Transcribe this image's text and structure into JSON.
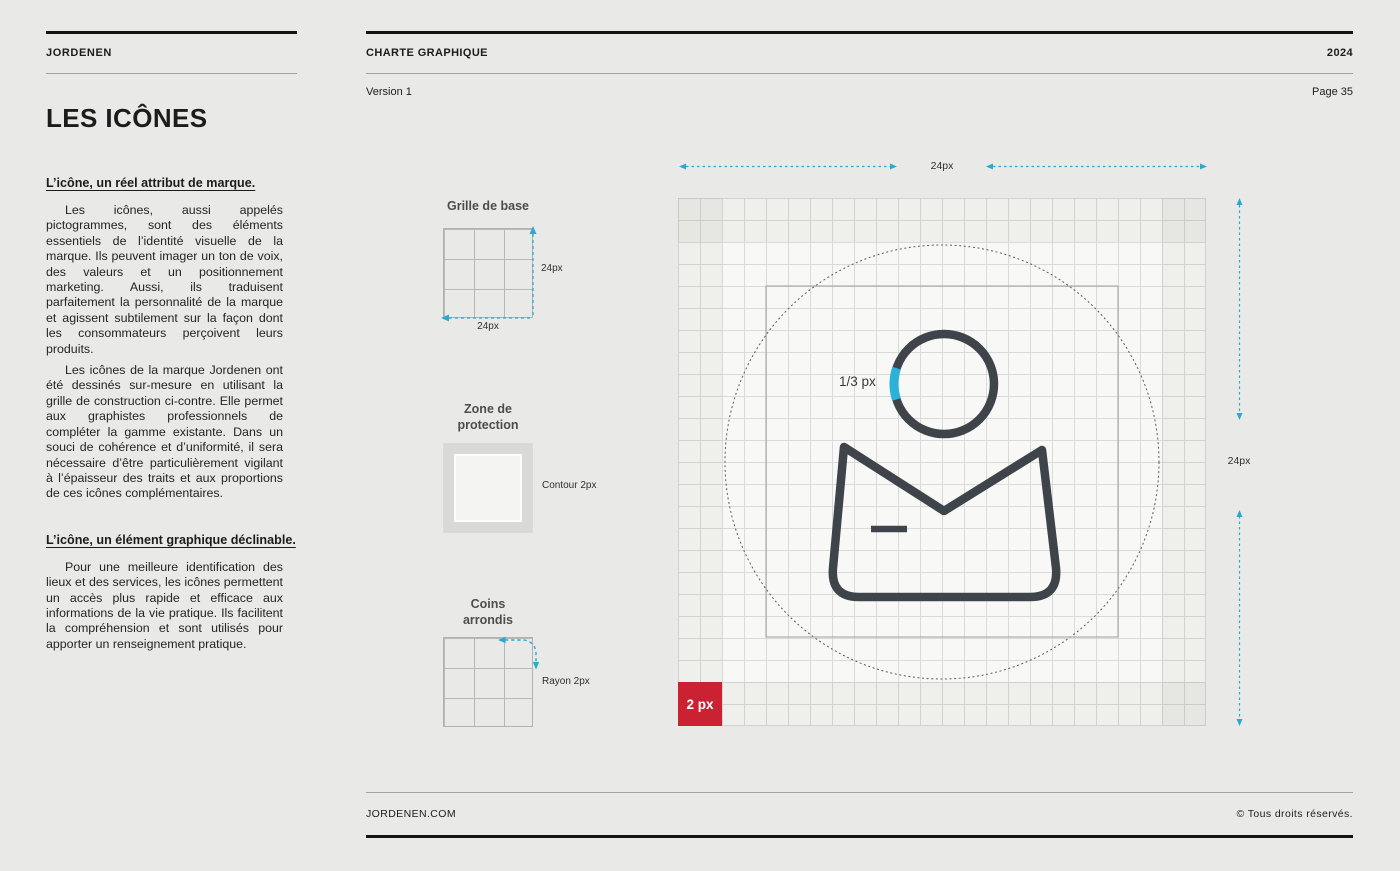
{
  "brand": "JORDENEN",
  "header": {
    "doc_title": "CHARTE GRAPHIQUE",
    "year": "2024",
    "version": "Version 1",
    "page": "Page 35"
  },
  "sidebar": {
    "title": "LES ICÔNES",
    "sections": [
      {
        "heading": "L’icône, un réel attribut de marque.",
        "paragraphs": [
          "Les icônes, aussi appelés pictogrammes, sont des éléments essentiels de l’identité visuelle de la marque. Ils peuvent imager un ton de voix, des valeurs et un positionnement marketing. Aussi, ils traduisent parfaitement la personnalité de la marque et agissent sub­tilement sur la façon dont les consommateurs perçoivent leurs produits.",
          "Les icônes de la marque Jordenen ont été dessinés sur-mesure en utilisant la grille de construction ci-contre. Elle permet aux graphistes professionnels de compléter la gamme existante. Dans un souci de co­hérence et d’uniformité, il sera nécessaire d’être particulièrement vigilant à l’épaisseur des traits et aux proportions de ces icônes complémentaires."
        ]
      },
      {
        "heading": "L’icône, un élément graphique déclinable.",
        "paragraphs": [
          "Pour une meilleure identification des lieux et des services, les icônes permettent un ac­cès plus rapide et efficace aux informations de la vie pratique. Ils facilitent la compréhen­sion et sont utilisés pour apporter un rensei­gnement pratique."
        ]
      }
    ]
  },
  "diagrams": {
    "base_grid": {
      "title": "Grille de base",
      "height_label": "24px",
      "width_label": "24px"
    },
    "protection": {
      "title": "Zone de protection",
      "label": "Contour 2px"
    },
    "corners": {
      "title": "Coins arrondis",
      "label": "Rayon 2px"
    }
  },
  "construction": {
    "top_dim_label": "24px",
    "right_dim_label": "24px",
    "stroke_label": "1/3 px",
    "badge_label": "2 px"
  },
  "colors": {
    "accent_cyan": "#2aa9d2",
    "badge_red": "#cb2233",
    "icon_stroke": "#3f444a",
    "page_background": "#e9e9e7"
  },
  "footer": {
    "site": "JORDENEN.COM",
    "rights": "© Tous droits réservés."
  }
}
